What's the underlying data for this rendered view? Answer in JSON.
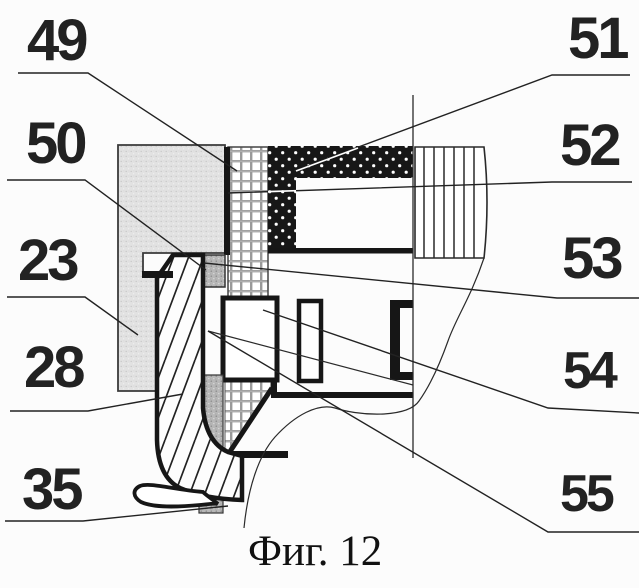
{
  "figure": {
    "caption": "Фиг. 12",
    "figure_number": "12",
    "type": "patent-sectional-drawing"
  },
  "callouts": {
    "49": "49",
    "50": "50",
    "23": "23",
    "28": "28",
    "35": "35",
    "51": "51",
    "52": "52",
    "53": "53",
    "54": "54",
    "55": "55"
  },
  "colors": {
    "paper": "#fcfcfc",
    "ink": "#161616",
    "line": "#2a2a2a",
    "stipple_base": "#e2e2e2",
    "speckle_base": "#b7b7b7",
    "label": "#222222"
  }
}
